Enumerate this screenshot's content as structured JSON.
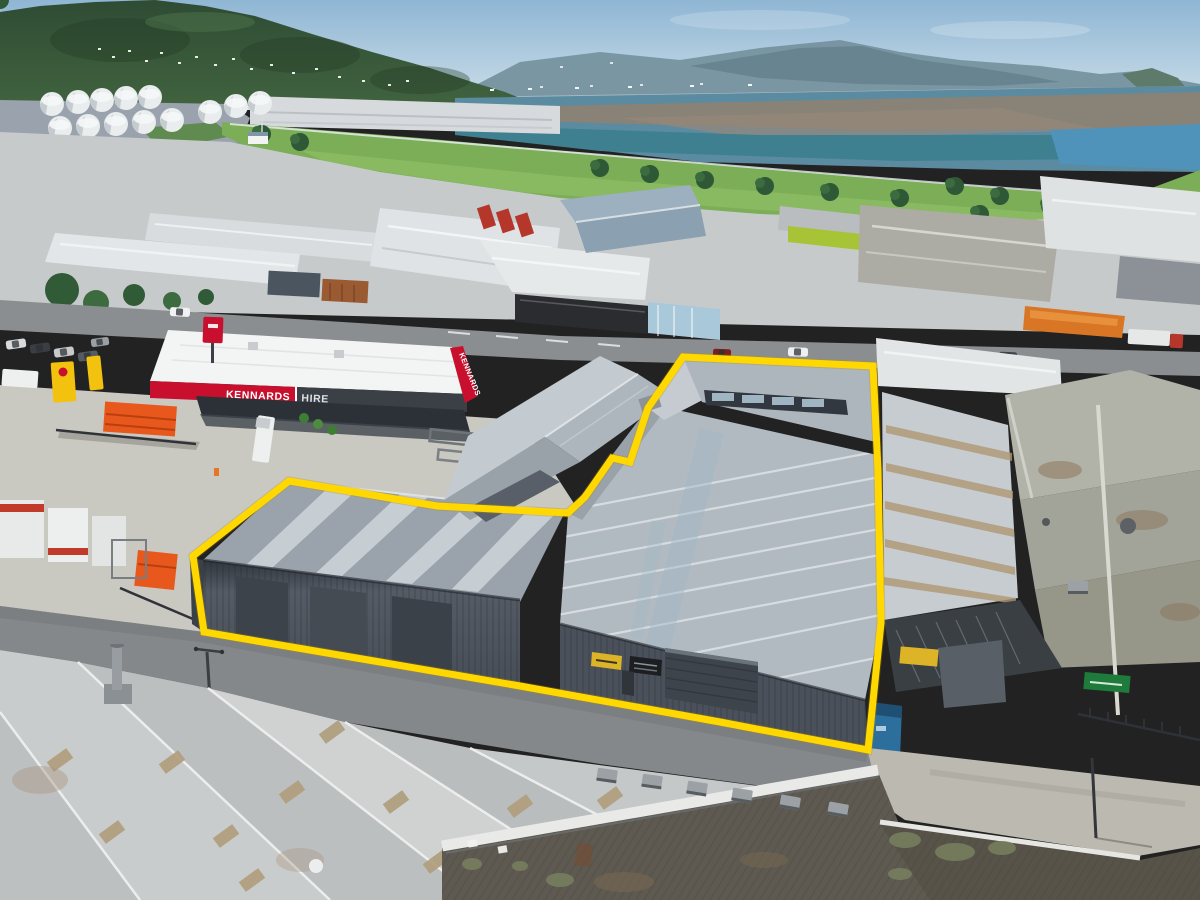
{
  "image": {
    "alt": "Aerial drone photograph of a seaside industrial suburb; a large grey warehouse property in the centre is outlined in bold yellow, with a Kennards Hire depot to its left, a harbour and bush-covered hills in the background, and weathered factory rooftops in the foreground."
  },
  "signage": {
    "kennards_sign": {
      "left": "KENNARDS",
      "right": "HIRE",
      "side": "KENNARDS"
    }
  },
  "overlay": {
    "outline_color": "#FFD800",
    "outline_width": "7",
    "outline_points": "193,556 289,481 437,506 568,513 585,497 612,458 630,462 648,408 683,357 873,366 878,470 881,623 868,750 720,722 520,686 380,662 204,632"
  },
  "palette": {
    "kennards_red": "#C8102E",
    "fascia_dark": "#3A4046",
    "lime_accent": "#A6C436",
    "hazard_sign_yellow": "#DDB428",
    "sign_green": "#1F7B3B",
    "container_blue": "#2D6F9C",
    "equipment_orange": "#E8581C",
    "park_grass": "#7CAE57",
    "water_teal": "#3E7F90",
    "water_sediment": "#8D8173",
    "subject_roof_grey": "#AEB6BE",
    "subject_wall_dark": "#4A515A"
  }
}
